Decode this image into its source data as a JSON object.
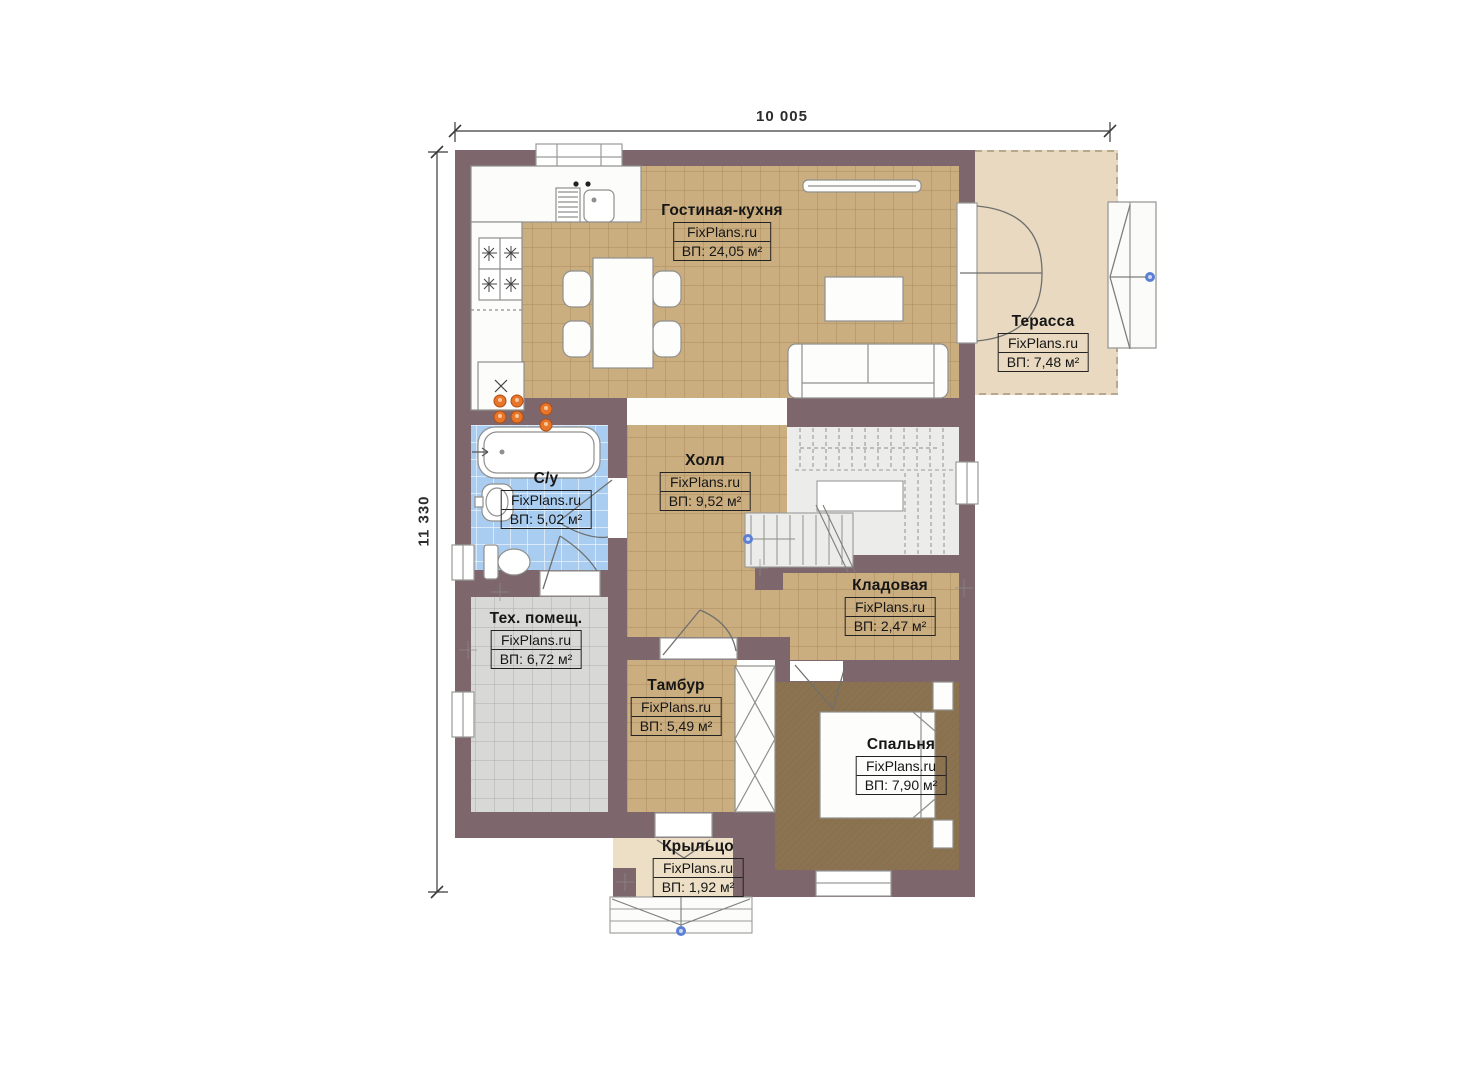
{
  "dimensions": {
    "top": "10 005",
    "left": "11 330"
  },
  "rooms": [
    {
      "id": "living",
      "name": "Гостиная-кухня",
      "brand": "FixPlans.ru",
      "area": "ВП: 24,05 м²"
    },
    {
      "id": "terrace",
      "name": "Терасса",
      "brand": "FixPlans.ru",
      "area": "ВП: 7,48 м²"
    },
    {
      "id": "bathroom",
      "name": "С/у",
      "brand": "FixPlans.ru",
      "area": "ВП: 5,02 м²"
    },
    {
      "id": "hall",
      "name": "Холл",
      "brand": "FixPlans.ru",
      "area": "ВП: 9,52 м²"
    },
    {
      "id": "storage",
      "name": "Кладовая",
      "brand": "FixPlans.ru",
      "area": "ВП: 2,47 м²"
    },
    {
      "id": "tech",
      "name": "Тех. помещ.",
      "brand": "FixPlans.ru",
      "area": "ВП: 6,72 м²"
    },
    {
      "id": "vestibule",
      "name": "Тамбур",
      "brand": "FixPlans.ru",
      "area": "ВП: 5,49 м²"
    },
    {
      "id": "bedroom",
      "name": "Спальня",
      "brand": "FixPlans.ru",
      "area": "ВП: 7,90 м²"
    },
    {
      "id": "porch",
      "name": "Крыльцо",
      "brand": "FixPlans.ru",
      "area": "ВП: 1,92 м²"
    }
  ],
  "colors": {
    "wall": "#7e676c",
    "tile_tan": "#cbae80",
    "tile_blue": "#a9cdf1",
    "tile_gray": "#d8d8d6",
    "carpet_brown": "#8b7351",
    "terrace_beige": "#e8d9c0",
    "porch_beige": "#eddec6",
    "stair_gray": "#ececea",
    "marker_blue": "#5b7fd4",
    "burner_orange": "#e8762a"
  }
}
